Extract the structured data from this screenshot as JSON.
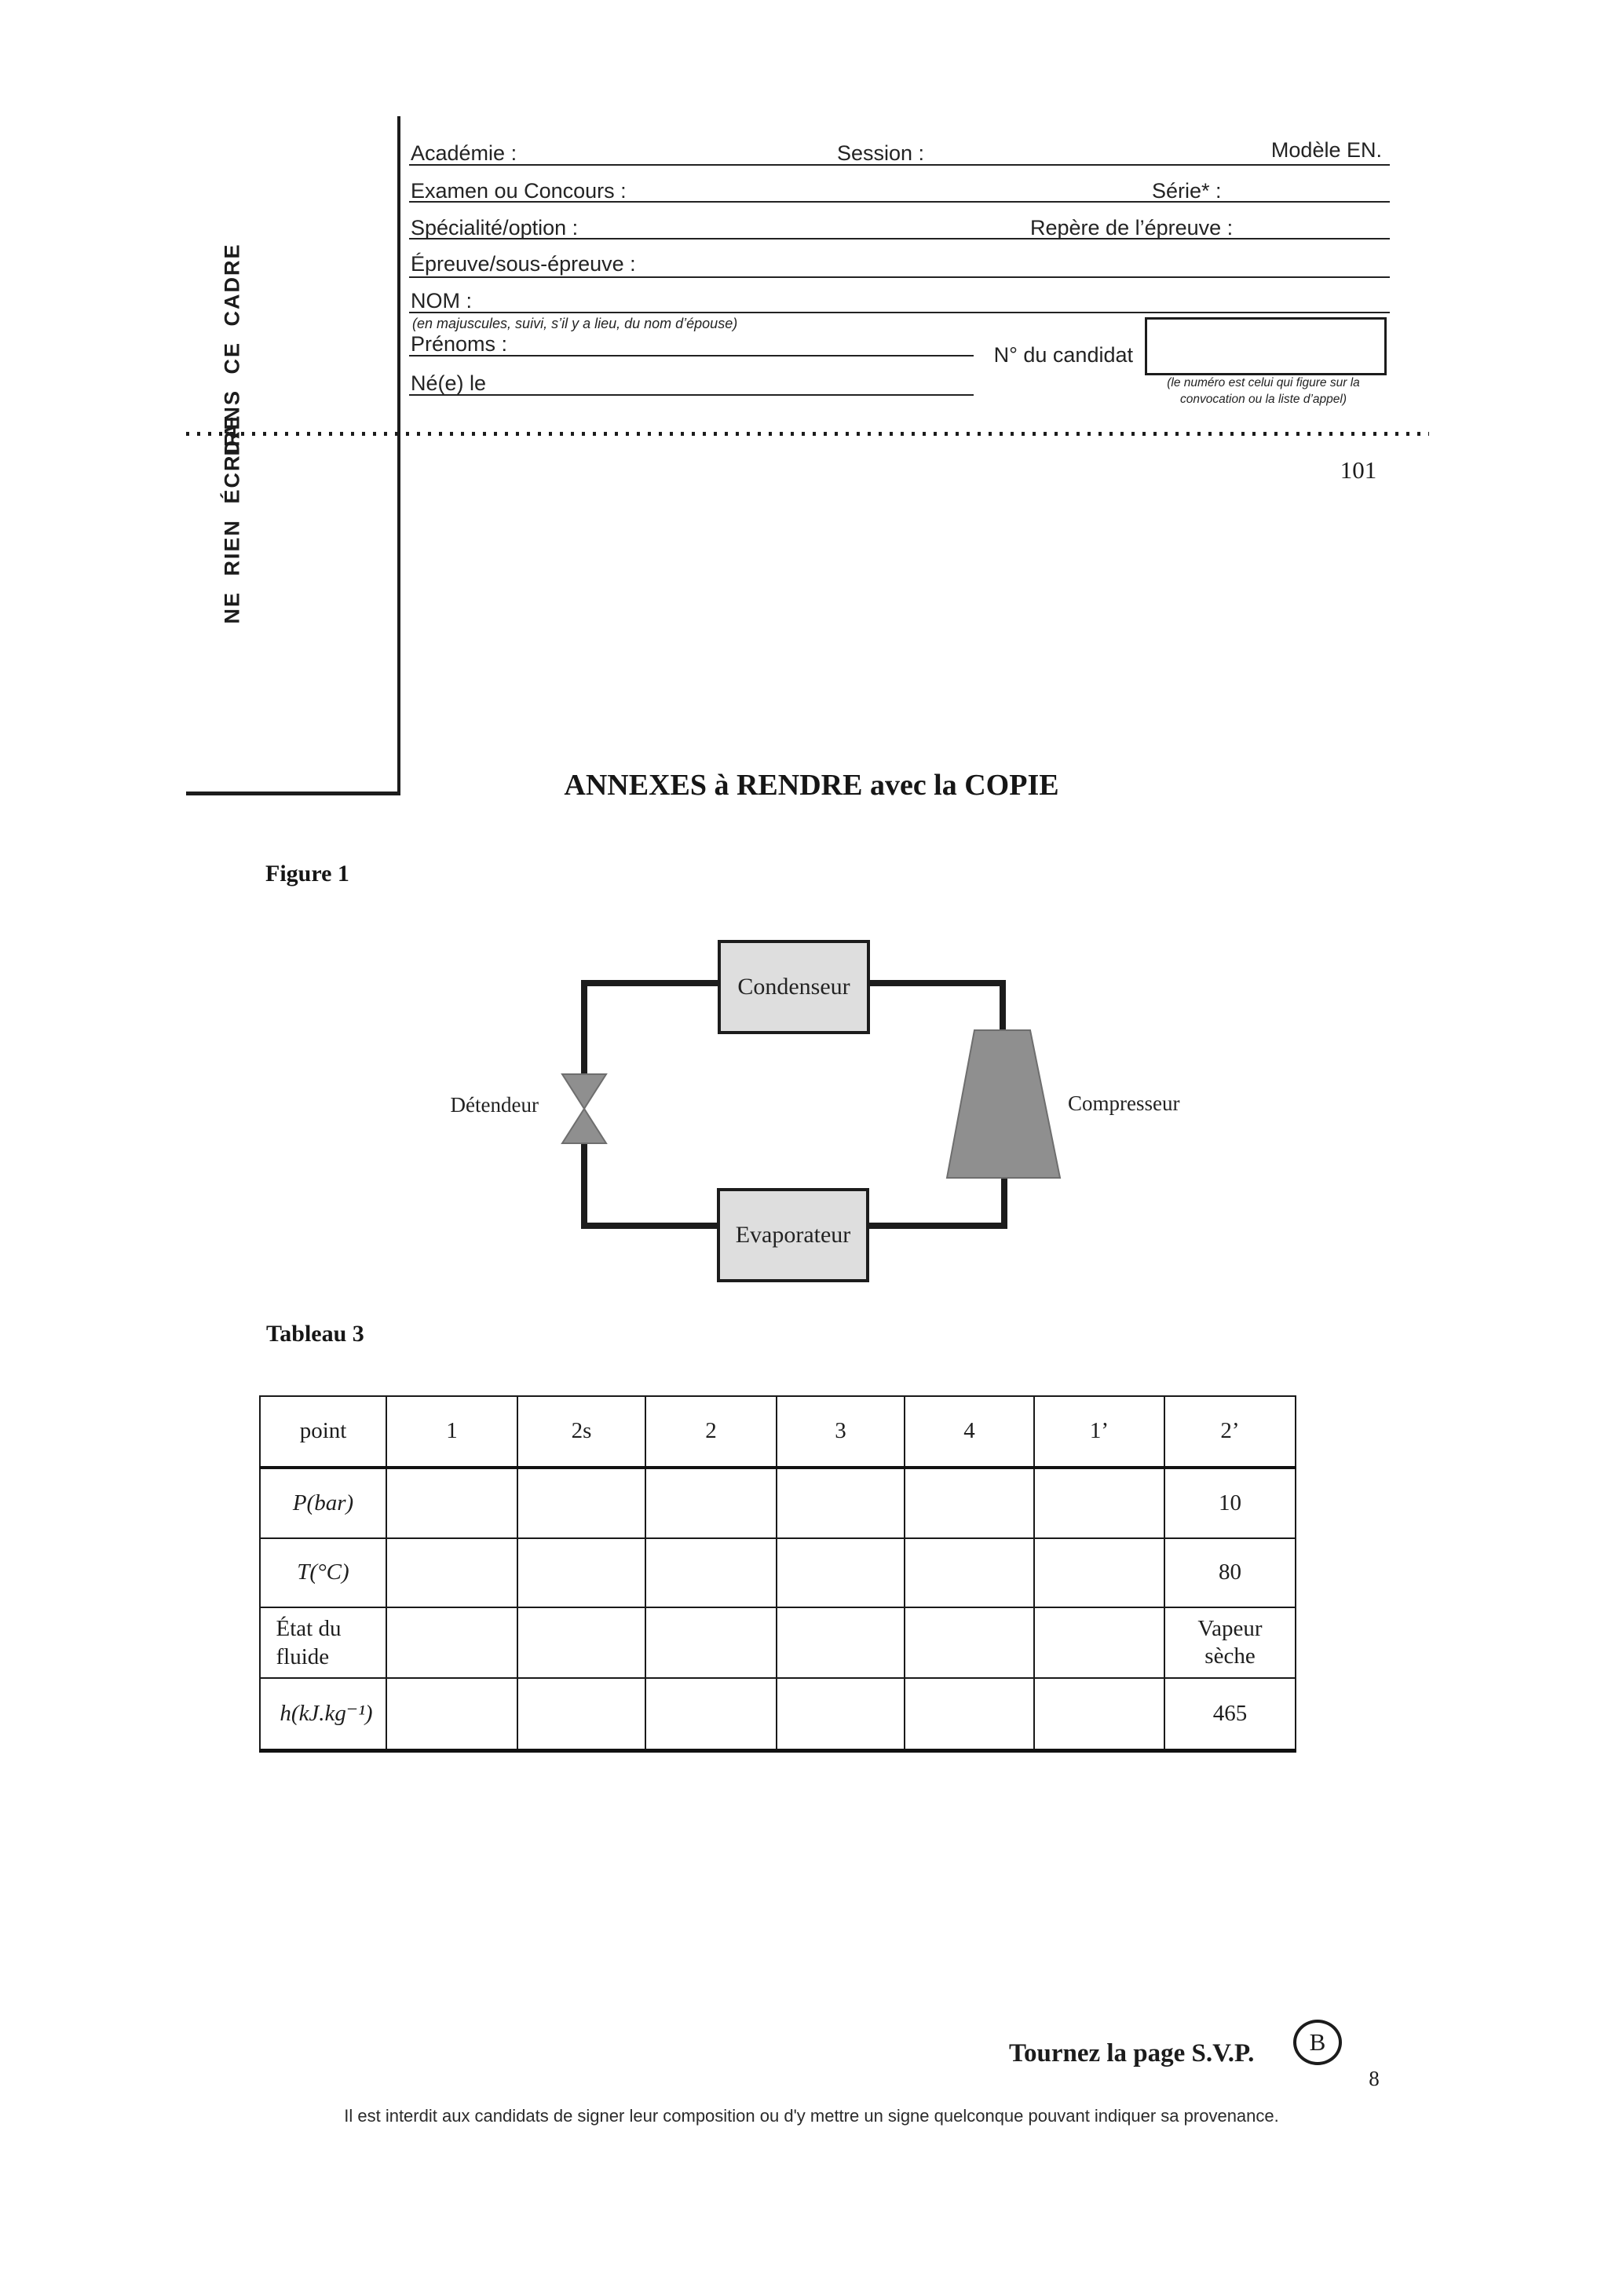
{
  "colors": {
    "paper": "#ffffff",
    "ink": "#1c1c1c",
    "diagram_box_fill": "#dedede",
    "component_fill": "#8f8f8f"
  },
  "header_form": {
    "frame_note_above": "DANS CE CADRE",
    "frame_note_below": "NE RIEN ÉCRIRE",
    "fields": {
      "academie": "Académie :",
      "session": "Session :",
      "modele": "Modèle EN.",
      "examen": "Examen ou Concours :",
      "serie": "Série* :",
      "specialite": "Spécialité/option :",
      "repere": "Repère de l’épreuve :",
      "epreuve": "Épreuve/sous-épreuve :",
      "nom": "NOM :",
      "nom_note": "(en majuscules, suivi, s’il y a lieu, du nom d’épouse)",
      "prenoms": "Prénoms :",
      "ne_le": "Né(e) le",
      "candidat": "N° du candidat",
      "candidat_note_line1": "(le numéro est celui qui figure sur la",
      "candidat_note_line2": "convocation ou la liste d’appel)"
    },
    "page_code": "101"
  },
  "main": {
    "title": "ANNEXES à RENDRE avec la COPIE",
    "figure_label": "Figure 1",
    "diagram": {
      "condenser": "Condenseur",
      "evaporator": "Evaporateur",
      "expansion_valve": "Détendeur",
      "compressor": "Compresseur"
    },
    "table_label": "Tableau 3",
    "table": {
      "header": [
        "point",
        "1",
        "2s",
        "2",
        "3",
        "4",
        "1’",
        "2’"
      ],
      "rows": [
        {
          "label": "P(bar)",
          "values": [
            "",
            "",
            "",
            "",
            "",
            "",
            "10"
          ]
        },
        {
          "label": "T(°C)",
          "values": [
            "",
            "",
            "",
            "",
            "",
            "",
            "80"
          ]
        },
        {
          "label": "État du fluide",
          "values": [
            "",
            "",
            "",
            "",
            "",
            "",
            "Vapeur sèche"
          ]
        },
        {
          "label": "h(kJ.kg⁻¹)",
          "values": [
            "",
            "",
            "",
            "",
            "",
            "",
            "465"
          ]
        }
      ]
    }
  },
  "footer": {
    "turn_page": "Tournez la page S.V.P.",
    "badge": "B",
    "page_number": "8",
    "warning": "Il est interdit aux candidats de signer leur composition ou d'y mettre un signe quelconque pouvant indiquer sa provenance."
  }
}
